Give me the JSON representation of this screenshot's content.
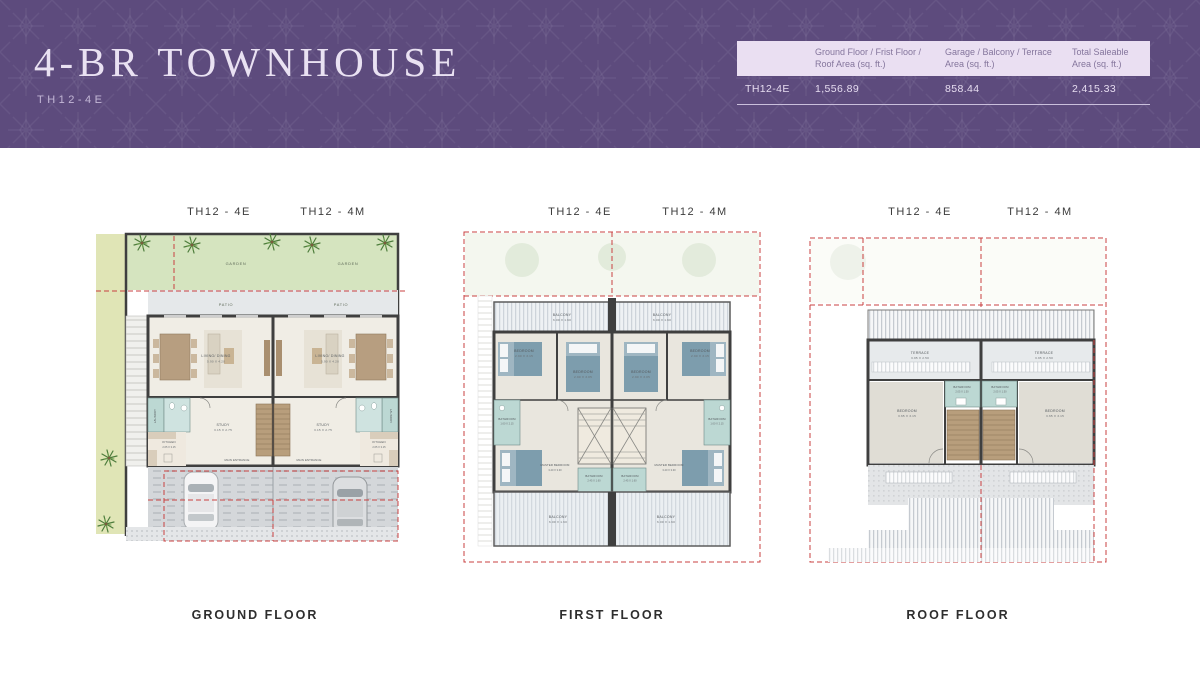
{
  "header": {
    "title": "4-BR TOWNHOUSE",
    "subtitle": "TH12-4E",
    "colors": {
      "band_purple": "#5d4b7d",
      "table_header_bg": "#eadff2",
      "red_dash": "#c94040",
      "bathroom_teal": "#bcd8d3",
      "garden_green": "#d5e4bf"
    }
  },
  "area_table": {
    "columns": [
      "Ground Floor / Frist Floor / Roof Area (sq. ft.)",
      "Garage / Balcony / Terrace Area (sq. ft.)",
      "Total Saleable Area (sq. ft.)"
    ],
    "row_label": "TH12-4E",
    "values": [
      "1,556.89",
      "858.44",
      "2,415.33"
    ]
  },
  "plans": {
    "ground": {
      "units": [
        "TH12 - 4E",
        "TH12 - 4M"
      ],
      "caption": "GROUND FLOOR",
      "labels": {
        "garden": "GARDEN",
        "patio": "PATIO",
        "living_name": "LIVING/ DINING",
        "living_dim": "5.90 X 4.20",
        "study_name": "STUDY",
        "study_dim": "3.15 X 2.75",
        "kitchen_name": "KITCHEN",
        "kitchen_dim": "2.65 X 3.15",
        "laundry": "LAUNDRY",
        "entrance": "MAIN ENTRANCE"
      }
    },
    "first": {
      "units": [
        "TH12 - 4E",
        "TH12 - 4M"
      ],
      "caption": "FIRST FLOOR",
      "labels": {
        "balcony_name": "BALCONY",
        "balcony_dim": "6.00 X 1.60",
        "bedroom_a_name": "BEDROOM",
        "bedroom_a_dim": "2.90 X 3.15",
        "bedroom_b_name": "BEDROOM",
        "bedroom_b_dim": "2.90 X 3.05",
        "bath_side_name": "BATHROOM",
        "bath_side_dim": "1.60 X 2.15",
        "master_name": "MASTER BEDROOM",
        "master_dim": "3.40 X 3.30",
        "bath_center_name": "BATHROOM",
        "bath_center_dim": "2.45 X 1.60",
        "balcony_rear_name": "BALCONY",
        "balcony_rear_dim": "6.00 X 1.60"
      }
    },
    "roof": {
      "units": [
        "TH12 - 4E",
        "TH12 - 4M"
      ],
      "caption": "ROOF FLOOR",
      "labels": {
        "terrace_name": "TERRACE",
        "terrace_dim": "3.95 X 2.50",
        "bath_name": "BATHROOM",
        "bath_dim": "2.05 X 1.50",
        "bedroom_name": "BEDROOM",
        "bedroom_dim": "3.65 X 3.15"
      }
    }
  }
}
